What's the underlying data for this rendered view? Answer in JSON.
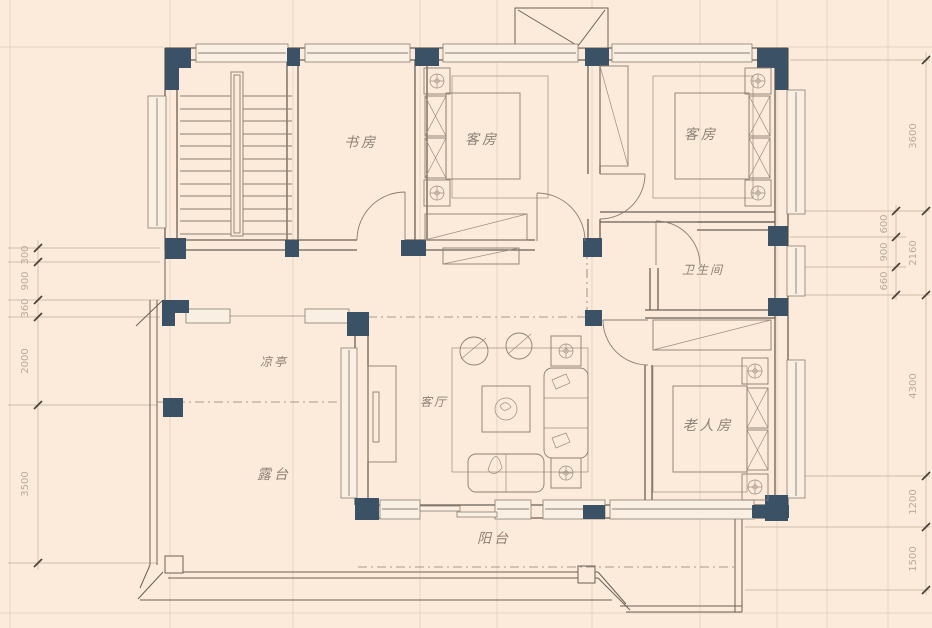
{
  "colors": {
    "background": "#fcebdb",
    "wall_line": "#6a6057",
    "column_fill": "#3b5166",
    "dimension_text": "#bcaa97",
    "room_label_text": "#8c8177"
  },
  "rooms": {
    "study": {
      "label": "书房"
    },
    "guest_room_1": {
      "label": "客房"
    },
    "guest_room_2": {
      "label": "客房"
    },
    "bathroom": {
      "label": "卫生间"
    },
    "pavilion": {
      "label": "凉亭"
    },
    "living_room": {
      "label": "客厅"
    },
    "elderly_room": {
      "label": "老人房"
    },
    "terrace": {
      "label": "露台"
    },
    "balcony": {
      "label": "阳台"
    }
  },
  "dimensions": {
    "left_chain": [
      "300",
      "900",
      "360",
      "2000",
      "3500"
    ],
    "right_inner_chain": [
      "600",
      "900",
      "660"
    ],
    "right_outer_chain": [
      "3600",
      "2160",
      "4300",
      "1200",
      "1500"
    ]
  }
}
